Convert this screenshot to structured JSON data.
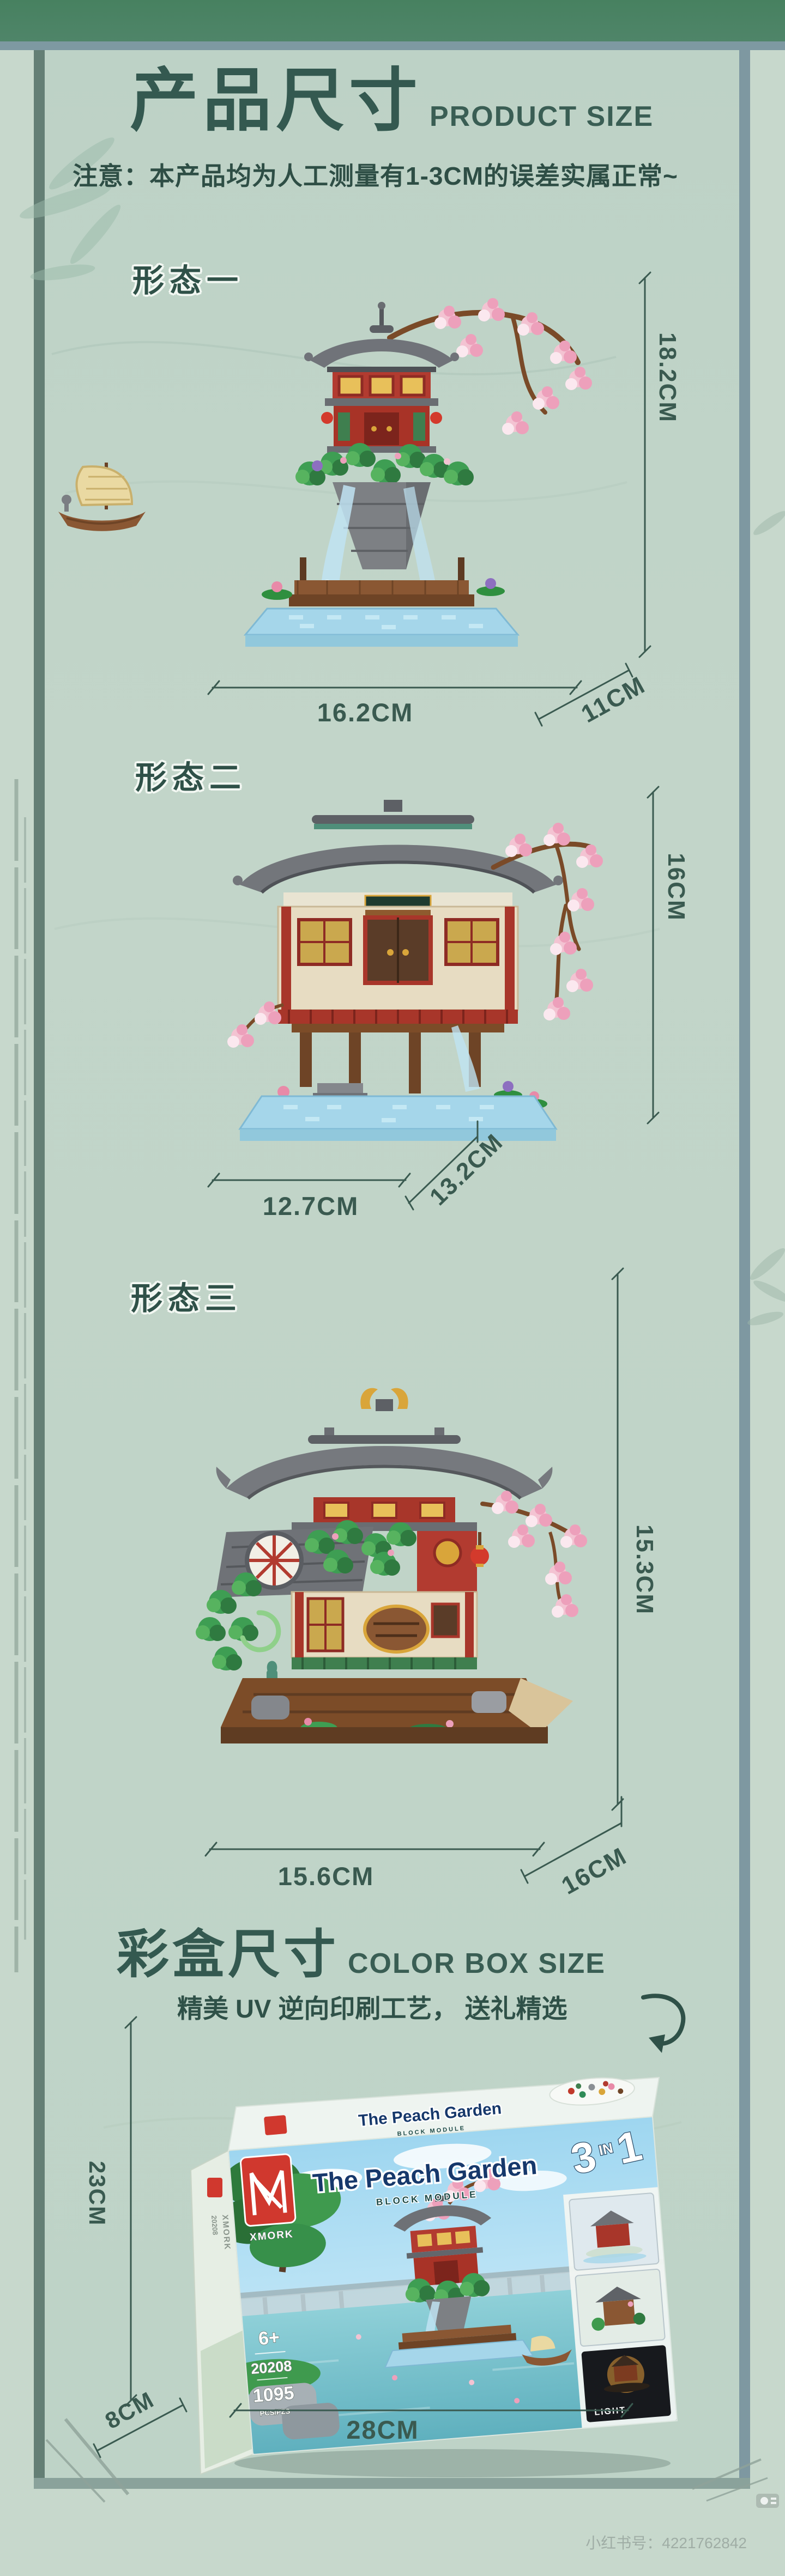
{
  "colors": {
    "page_bg": "#c7d8cc",
    "panel_bg": "#bed3c7",
    "top_bar": "#4c8267",
    "title_text": "#345950",
    "dimension": "#3a5a50",
    "brand_red": "#d0382e",
    "box_title_blue": "#16386b"
  },
  "header": {
    "title_cn": "产品尺寸",
    "title_en": "PRODUCT SIZE",
    "notice": "注意：本产品均为人工测量有1-3CM的误差实属正常~"
  },
  "sections": [
    {
      "label": "形态一",
      "height": "18.2CM",
      "width": "16.2CM",
      "depth": "11CM"
    },
    {
      "label": "形态二",
      "height": "16CM",
      "width": "12.7CM",
      "depth": "13.2CM"
    },
    {
      "label": "形态三",
      "height": "15.3CM",
      "width": "15.6CM",
      "depth": "16CM"
    }
  ],
  "box_section": {
    "title_cn": "彩盒尺寸",
    "title_en": "COLOR BOX SIZE",
    "subtitle": "精美 UV 逆向印刷工艺， 送礼精选",
    "height": "23CM",
    "depth": "8CM",
    "width": "28CM",
    "box": {
      "brand": "XMORK",
      "title": "The Peach Garden",
      "module": "BLOCK MODULE",
      "badge_3": "3",
      "badge_in": "IN",
      "badge_1": "1",
      "age": "6+",
      "item_no": "20208",
      "pieces": "1095",
      "pieces_label": "PCS/PZS",
      "light_label": "LIGHT"
    }
  },
  "watermark": {
    "text": "小红书号：4221762842"
  }
}
